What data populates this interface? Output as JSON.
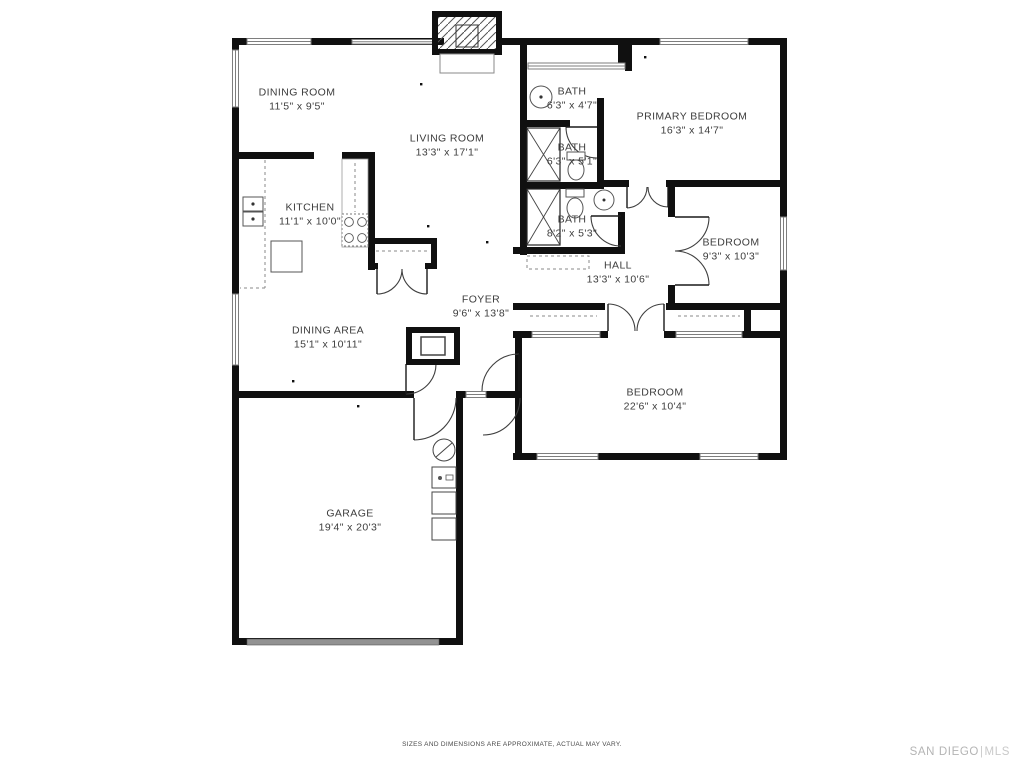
{
  "footer": {
    "disclaimer": "SIZES AND DIMENSIONS ARE APPROXIMATE, ACTUAL MAY VARY.",
    "brand_name": "SAN DIEGO",
    "brand_divider": "|",
    "brand_suffix": "MLS"
  },
  "colors": {
    "wall": "#101010",
    "window_stroke": "#7e7e7e",
    "door_arc": "#3f3f3f",
    "dashed_detail": "#888888",
    "label_text": "#3d3d3d",
    "brand_text": "#b4b4b4",
    "garage_door_fill": "#929292"
  },
  "rooms": [
    {
      "id": "dining-room",
      "name": "DINING ROOM",
      "dims": "11'5\" x 9'5\""
    },
    {
      "id": "living-room",
      "name": "LIVING ROOM",
      "dims": "13'3\" x 17'1\""
    },
    {
      "id": "kitchen",
      "name": "KITCHEN",
      "dims": "11'1\" x 10'0\""
    },
    {
      "id": "bath-top",
      "name": "BATH",
      "dims": "6'3\" x 4'7\""
    },
    {
      "id": "bath-middle",
      "name": "BATH",
      "dims": "6'3\" x 5'1\""
    },
    {
      "id": "bath-bottom",
      "name": "BATH",
      "dims": "8'2\" x 5'3\""
    },
    {
      "id": "primary-bedroom",
      "name": "PRIMARY BEDROOM",
      "dims": "16'3\" x 14'7\""
    },
    {
      "id": "bedroom-small",
      "name": "BEDROOM",
      "dims": "9'3\" x 10'3\""
    },
    {
      "id": "hall",
      "name": "HALL",
      "dims": "13'3\" x 10'6\""
    },
    {
      "id": "foyer",
      "name": "FOYER",
      "dims": "9'6\" x 13'8\""
    },
    {
      "id": "dining-area",
      "name": "DINING AREA",
      "dims": "15'1\" x 10'11\""
    },
    {
      "id": "bedroom-large",
      "name": "BEDROOM",
      "dims": "22'6\" x 10'4\""
    },
    {
      "id": "garage",
      "name": "GARAGE",
      "dims": "19'4\" x 20'3\""
    }
  ],
  "fixtures": [
    "fireplace-icon",
    "foyer-fireplace-icon",
    "kitchen-sink-icon",
    "kitchen-island-icon",
    "stove-icon",
    "pantry-closet-icon",
    "shower-icon",
    "toilet-icon",
    "round-sink-icon",
    "linen-counter-icon",
    "closet-shelf-icon",
    "sliding-door-icon",
    "door-swing-icon",
    "window-icon",
    "garage-door-icon",
    "water-heater-icon",
    "laundry-appliance-icon"
  ]
}
